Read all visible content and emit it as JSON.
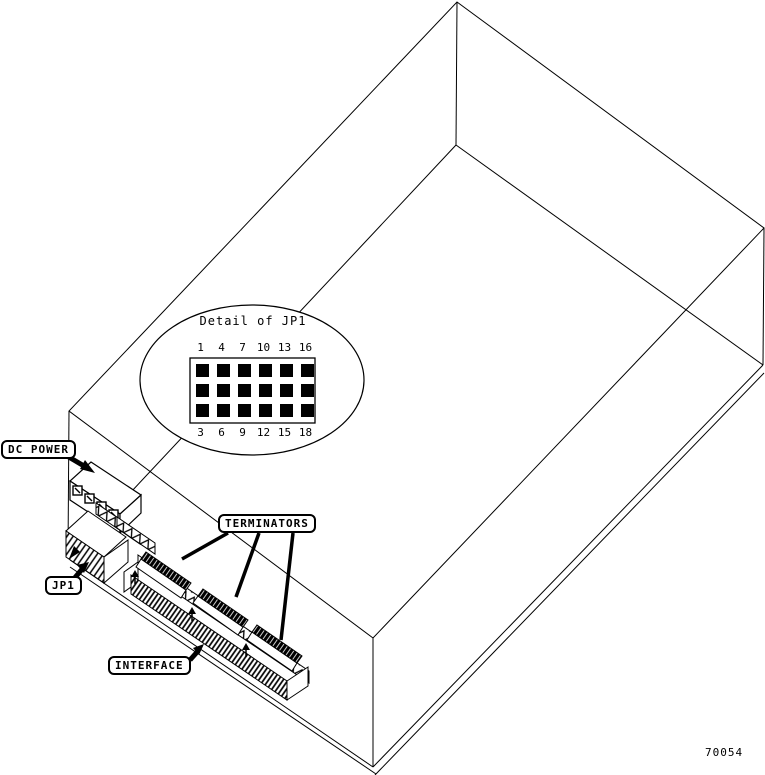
{
  "figure_number": "70054",
  "labels": {
    "dc_power": "DC POWER",
    "jp1": "JP1",
    "terminators": "TERMINATORS",
    "interface": "INTERFACE"
  },
  "jp1_detail": {
    "title": "Detail of JP1",
    "top_row": [
      "1",
      "4",
      "7",
      "10",
      "13",
      "16"
    ],
    "bottom_row": [
      "3",
      "6",
      "9",
      "12",
      "15",
      "18"
    ],
    "pin_rows": 3,
    "pin_columns": 6
  },
  "colors": {
    "line": "#000000",
    "background": "#ffffff"
  }
}
